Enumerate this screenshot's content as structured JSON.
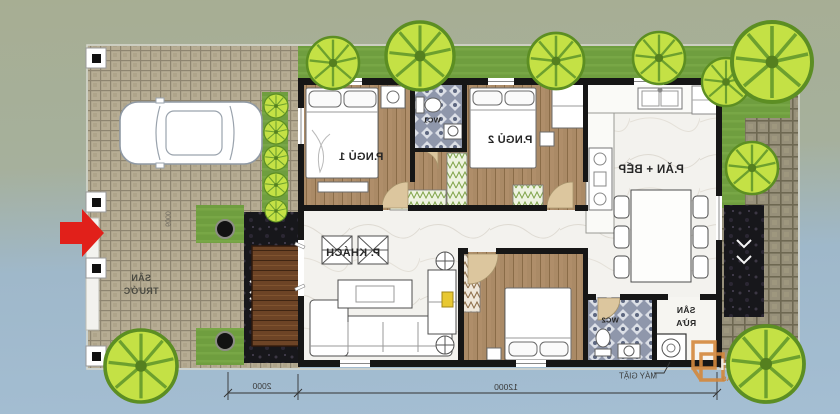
{
  "plan": {
    "rooms": {
      "bedroom1": "P.NGỦ 1",
      "bedroom2": "P.NGỦ 2",
      "wc1": "WC1",
      "wc2": "WC2",
      "living": "P. KHÁCH",
      "dining_kitchen": "P.ĂN + BẾP",
      "wash_yard_line1": "SÂN",
      "wash_yard_line2": "RỬA",
      "front_yard_line1": "SÂN",
      "front_yard_line2": "TRƯỚC"
    },
    "annotations": {
      "washing_machine": "MÁY GIẶT"
    },
    "dimensions": {
      "front_yard_width": "2000",
      "house_length": "12000",
      "lot_depth": "6000"
    }
  },
  "watermark": {
    "brand": "HOUSE",
    "tagline_left": "BẢN MIỄN PHÍ",
    "tagline_right": "MUA KHỞ Ý"
  },
  "colors": {
    "bg_top": "#a7ae93",
    "bg_bottom": "#a4bed3",
    "grass": "#6f9e3f",
    "tree": "#c4e145",
    "wall": "#161616",
    "wood_floor": "#aa8a66",
    "marble_floor": "#f3f2ee",
    "mosaic_tile": "#8f97ab",
    "entry_arrow": "#e1201a",
    "watermark_orange": "#d4883c"
  }
}
